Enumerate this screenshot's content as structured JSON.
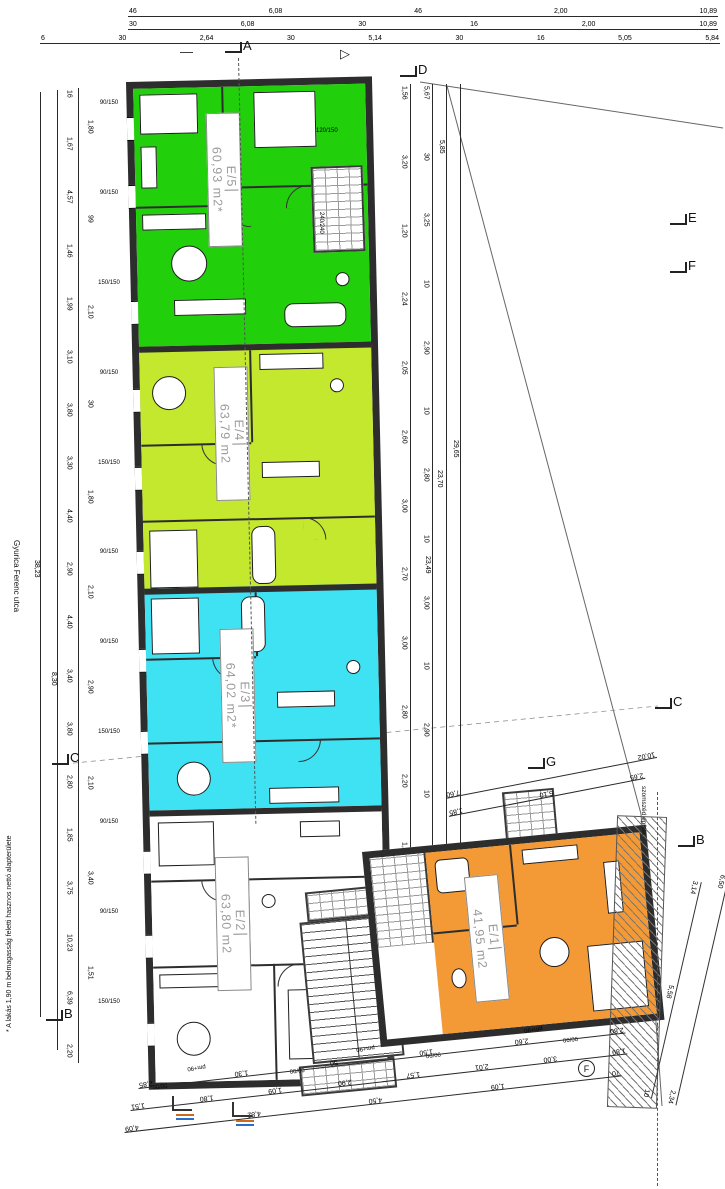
{
  "drawing": {
    "street_label": "Gyurica Ferenc utca",
    "footnote": "* A lakás 1,90 m belmagasság feletti hasznos nettó alapterülete",
    "neighbor_label": "szomszéd épület"
  },
  "apartments": [
    {
      "id": "E/5",
      "area": "60,93 m2*",
      "color": "#22cf0b"
    },
    {
      "id": "E/4",
      "area": "63,79 m2",
      "color": "#c3e82e"
    },
    {
      "id": "E/3",
      "area": "64,02 m2*",
      "color": "#3fe2f2"
    },
    {
      "id": "E/2",
      "area": "63,80 m2",
      "color": "#ffffff"
    },
    {
      "id": "E/1",
      "area": "41,95 m2",
      "color": "#f39a36"
    }
  ],
  "markers": {
    "a": "A",
    "d": "D",
    "e": "E",
    "f": "F",
    "c_left": "C",
    "c_right": "C",
    "g": "G",
    "b_left": "B",
    "b_right": "B",
    "f_circle": "F"
  },
  "dimensions": {
    "top_row1": [
      "46",
      "6,08",
      "46",
      "2,00",
      "10,89"
    ],
    "top_row2": [
      "30",
      "6,08",
      "30",
      "16",
      "2,00",
      "10,89"
    ],
    "top_row3": [
      "6",
      "30",
      "2,64",
      "30",
      "5,14",
      "30",
      "16",
      "5,05",
      "5,84"
    ],
    "left_chain": [
      "16",
      "1,67",
      "4,57",
      "1,46",
      "1,99",
      "3,10",
      "3,80",
      "3,30",
      "4,40",
      "2,90",
      "4,40",
      "3,40",
      "3,80",
      "2,80",
      "1,85",
      "3,75",
      "10,23",
      "6,39",
      "2,20"
    ],
    "left_inner": [
      "1,80",
      "99",
      "2,10",
      "30",
      "1,80",
      "2,10",
      "2,90",
      "2,10",
      "3,40",
      "1,51"
    ],
    "left_total_1": "38,23",
    "left_total_2": "8,30",
    "right_chain1": [
      "1,56",
      "3,20",
      "1,20",
      "2,24",
      "2,05",
      "2,60",
      "3,00",
      "2,70",
      "3,00",
      "2,80",
      "2,20",
      "1,40"
    ],
    "right_chain2": [
      "5,67",
      "30",
      "3,25",
      "10",
      "2,90",
      "10",
      "2,80",
      "10",
      "3,00",
      "10",
      "2,90",
      "10",
      "2,85"
    ],
    "right_top": "5,85",
    "right_total_1": "23,70",
    "right_total_2": "23,49",
    "right_total_3": "29,65",
    "bottom_chain1": [
      "2,85",
      "1,30",
      "50",
      "1,50",
      "2,60",
      "2,80"
    ],
    "bottom_chain2": [
      "1,51",
      "1,80",
      "1,09",
      "2,90",
      "1,57",
      "2,01",
      "3,00",
      "1,89"
    ],
    "bottom_chain3": [
      "4,09",
      "4,82",
      "4,50",
      "1,09",
      "70"
    ],
    "g_chain1": [
      "1,85",
      "5,10",
      "2,65"
    ],
    "g_chain2": [
      "7,60",
      "10,02"
    ],
    "b_chain1": [
      "3,14",
      "5,58",
      "10"
    ],
    "b_chain2": [
      "6,50",
      "2,34"
    ]
  },
  "windows": {
    "left": [
      "90/150",
      "90/150",
      "150/150",
      "90/150",
      "150/150",
      "90/150",
      "90/150",
      "150/150",
      "90/150",
      "90/150",
      "150/150"
    ],
    "right_1": "120/150",
    "right_2": "240/240",
    "bottom": [
      "90/90",
      "90/90",
      "90/90",
      "90/90"
    ],
    "doors": [
      "pm+90",
      "pm+90",
      "pm+90"
    ]
  }
}
